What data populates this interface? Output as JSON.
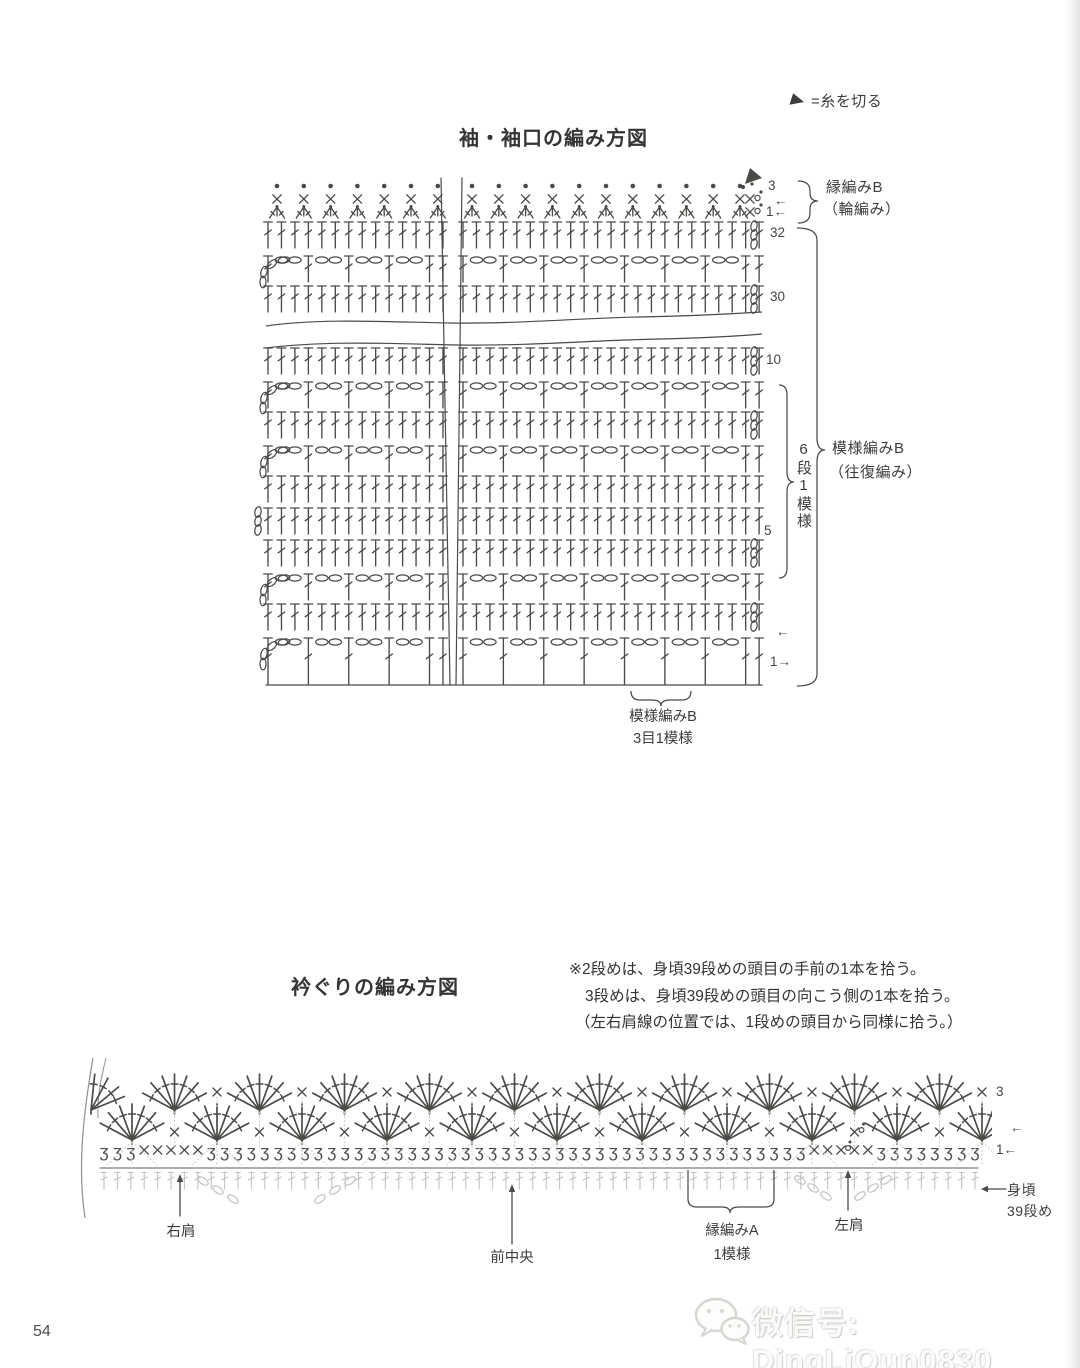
{
  "colors": {
    "ink": "#4a4a47",
    "light": "#c3c2be",
    "faint": "#cfcecb",
    "marker": "#454543"
  },
  "legend": {
    "cut_yarn_label": "=糸を切る"
  },
  "sleeve_chart": {
    "title": "袖・袖口の編み方図",
    "edge_label": "縁編みB",
    "edge_label_sub": "（輪編み）",
    "pattern_label": "模様編みB",
    "pattern_label_sub": "（往復編み）",
    "repeat_label": "6段1模様",
    "bottom_label": "模様編みB",
    "bottom_label_sub": "3目1模様"
  },
  "neck_chart": {
    "title": "衿ぐりの編み方図",
    "notes": [
      "※2段めは、身頃39段めの頭目の手前の1本を拾う。",
      "3段めは、身頃39段めの頭目の向こう側の1本を拾う。",
      "（左右肩線の位置では、1段めの頭目から同様に拾う。）"
    ],
    "right_shoulder": "右肩",
    "front_center": "前中央",
    "edge_a_label": "縁編みA",
    "edge_a_sub": "1模様",
    "left_shoulder": "左肩",
    "body_label": "身頃",
    "body_label2": "39段め"
  },
  "footer": {
    "page_number": "54",
    "watermark": "微信号: DingLiQun0830"
  },
  "chart_data": [
    {
      "id": "sleeve",
      "type": "crochet-symbol-chart",
      "sections": [
        [
          268,
          443
        ],
        [
          463,
          762
        ]
      ],
      "stitch_spacing": 13.46,
      "edge_spacing": 26.8,
      "rows": [
        {
          "type": "dots",
          "y": 186
        },
        {
          "type": "sc",
          "y": 199
        },
        {
          "type": "dec",
          "y": 207
        },
        {
          "type": "dc",
          "y": 222,
          "turn": "right8"
        },
        {
          "type": "mesh",
          "y": 254,
          "turn": "leftcurve"
        },
        {
          "type": "dc",
          "y": 286,
          "turn": "right8"
        },
        {
          "type": "wave",
          "y": 318
        },
        {
          "type": "dc",
          "y": 348,
          "turn": "right8"
        },
        {
          "type": "mesh",
          "y": 380,
          "turn": "leftcurve"
        },
        {
          "type": "dc",
          "y": 412,
          "turn": "right8"
        },
        {
          "type": "mesh",
          "y": 444,
          "turn": "leftcurve"
        },
        {
          "type": "dc",
          "y": 476
        },
        {
          "type": "dc",
          "y": 508,
          "turn": "left8"
        },
        {
          "type": "dc",
          "y": 540,
          "turn": "right8"
        },
        {
          "type": "mesh",
          "y": 572,
          "turn": "leftcurve"
        },
        {
          "type": "dc",
          "y": 604,
          "turn": "right8"
        },
        {
          "type": "mesh",
          "y": 636,
          "turn": "leftcurve",
          "tall": true
        },
        {
          "type": "baseline",
          "y": 685
        }
      ],
      "break_lines": [
        [
          441,
          178,
          450,
          685
        ],
        [
          462,
          178,
          456,
          685
        ]
      ],
      "row_markers": [
        {
          "t": "3",
          "x": 768,
          "y": 186
        },
        {
          "t": "←",
          "x": 774,
          "y": 201
        },
        {
          "t": "1←",
          "x": 766,
          "y": 212
        },
        {
          "t": "32",
          "x": 770,
          "y": 233
        },
        {
          "t": "30",
          "x": 770,
          "y": 297
        },
        {
          "t": "10",
          "x": 766,
          "y": 360
        },
        {
          "t": "5",
          "x": 764,
          "y": 531
        },
        {
          "t": "←",
          "x": 776,
          "y": 632
        },
        {
          "t": "1→",
          "x": 770,
          "y": 662
        }
      ]
    },
    {
      "id": "neck",
      "type": "crochet-symbol-chart",
      "loop_glyph": "ʒ",
      "loops": {
        "start": 104,
        "end": 976,
        "spacing": 13.4,
        "y": 1150
      },
      "shoulder_x_right": [
        3,
        4,
        5,
        6,
        7
      ],
      "shoulder_x_left": [
        53,
        54,
        56,
        57
      ],
      "standing_loop_index": 55,
      "fan_rows": [
        {
          "base_y": 1140,
          "start": 132,
          "count": 11,
          "spacing": 85,
          "x_y": 1132,
          "standing_x_index": 8
        },
        {
          "base_y": 1110,
          "start": 174.5,
          "count": 10,
          "spacing": 85,
          "x_y": 1092,
          "partial_left_x": 91
        }
      ],
      "body_line": {
        "x1": 100,
        "x2": 978,
        "y": 1168
      },
      "row_markers": [
        {
          "t": "3",
          "x": 996,
          "y": 1092
        },
        {
          "t": "←",
          "x": 1010,
          "y": 1128
        },
        {
          "t": "1←",
          "x": 996,
          "y": 1150
        }
      ]
    }
  ]
}
